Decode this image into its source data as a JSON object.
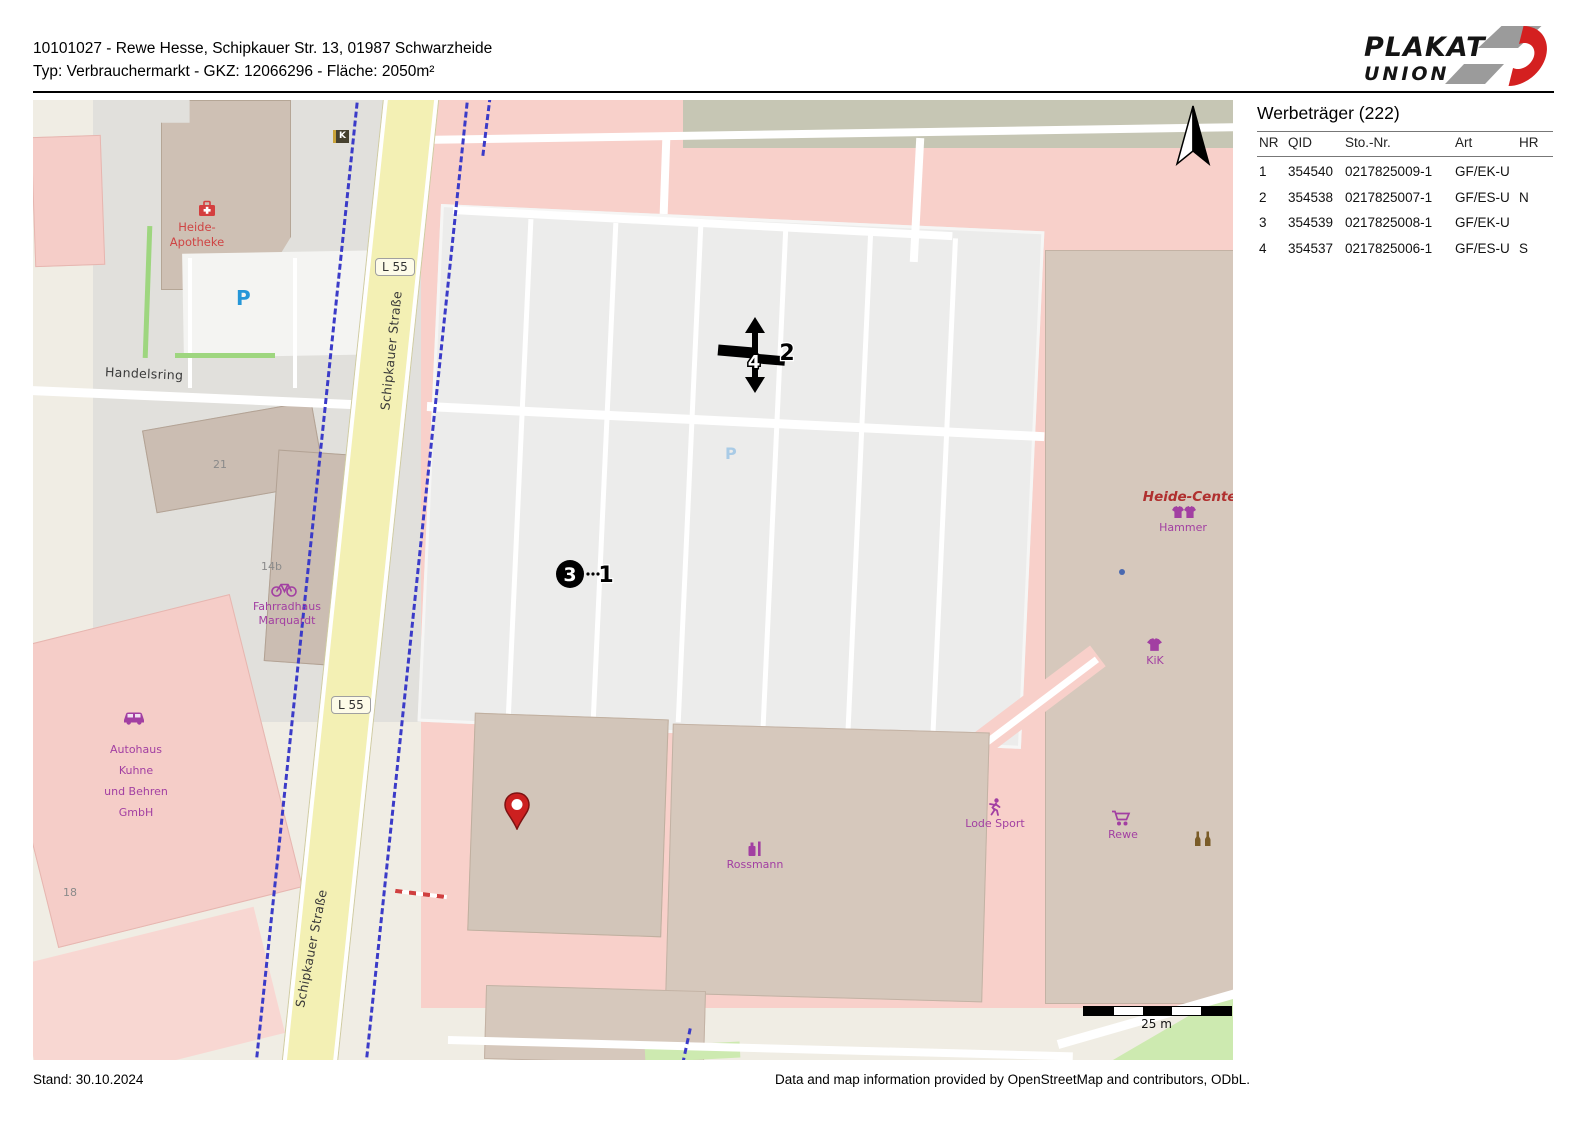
{
  "header": {
    "title_line1": "10101027 - Rewe Hesse, Schipkauer Str. 13, 01987 Schwarzheide",
    "title_line2": "Typ: Verbrauchermarkt - GKZ: 12066296 - Fläche: 2050m²",
    "logo_line1": "PLAKAT",
    "logo_line2": "UNION"
  },
  "panel": {
    "title": "Werbeträger (222)",
    "columns": {
      "nr": "NR",
      "qid": "QID",
      "sto": "Sto.-Nr.",
      "art": "Art",
      "hr": "HR"
    },
    "rows": [
      {
        "nr": "1",
        "qid": "354540",
        "sto": "0217825009-1",
        "art": "GF/EK-U",
        "hr": ""
      },
      {
        "nr": "2",
        "qid": "354538",
        "sto": "0217825007-1",
        "art": "GF/ES-U",
        "hr": "N"
      },
      {
        "nr": "3",
        "qid": "354539",
        "sto": "0217825008-1",
        "art": "GF/EK-U",
        "hr": ""
      },
      {
        "nr": "4",
        "qid": "354537",
        "sto": "0217825006-1",
        "art": "GF/ES-U",
        "hr": "S"
      }
    ]
  },
  "map": {
    "streets": {
      "handelsring": "Handelsring",
      "schipkauer": "Schipkauer Straße",
      "l55": "L 55"
    },
    "house_numbers": {
      "n21": "21",
      "n14b": "14b",
      "n18": "18"
    },
    "parking_letter": "P",
    "kiosk_letter": "K",
    "pois": {
      "apotheke_line1": "Heide-",
      "apotheke_line2": "Apotheke",
      "fahrradhaus_line1": "Fahrradhaus",
      "fahrradhaus_line2": "Marquardt",
      "autohaus_line1": "Autohaus",
      "autohaus_line2": "Kuhne",
      "autohaus_line3": "und Behren",
      "autohaus_line4": "GmbH",
      "heide_center": "Heide-Center",
      "hammer": "Hammer",
      "kik": "KiK",
      "rossmann": "Rossmann",
      "lode_sport": "Lode Sport",
      "rewe": "Rewe"
    },
    "markers": {
      "m1": "1",
      "m2": "2",
      "m3": "3",
      "m4": "4"
    },
    "scale_label": "25 m"
  },
  "footer": {
    "stand": "Stand: 30.10.2024",
    "attribution": "Data and map information provided by OpenStreetMap and contributors, ODbL."
  },
  "colors": {
    "poi_purple": "#a23fa2",
    "poi_red": "#c0392b",
    "parking_blue": "#2596d8",
    "road_yellow": "#f3f0b4",
    "pink_zone": "#f8d0ca",
    "building": "#d6c8bc",
    "cycleway": "#3b3bc8",
    "pin_red": "#cc2020",
    "topband": "#c6c6b4"
  }
}
